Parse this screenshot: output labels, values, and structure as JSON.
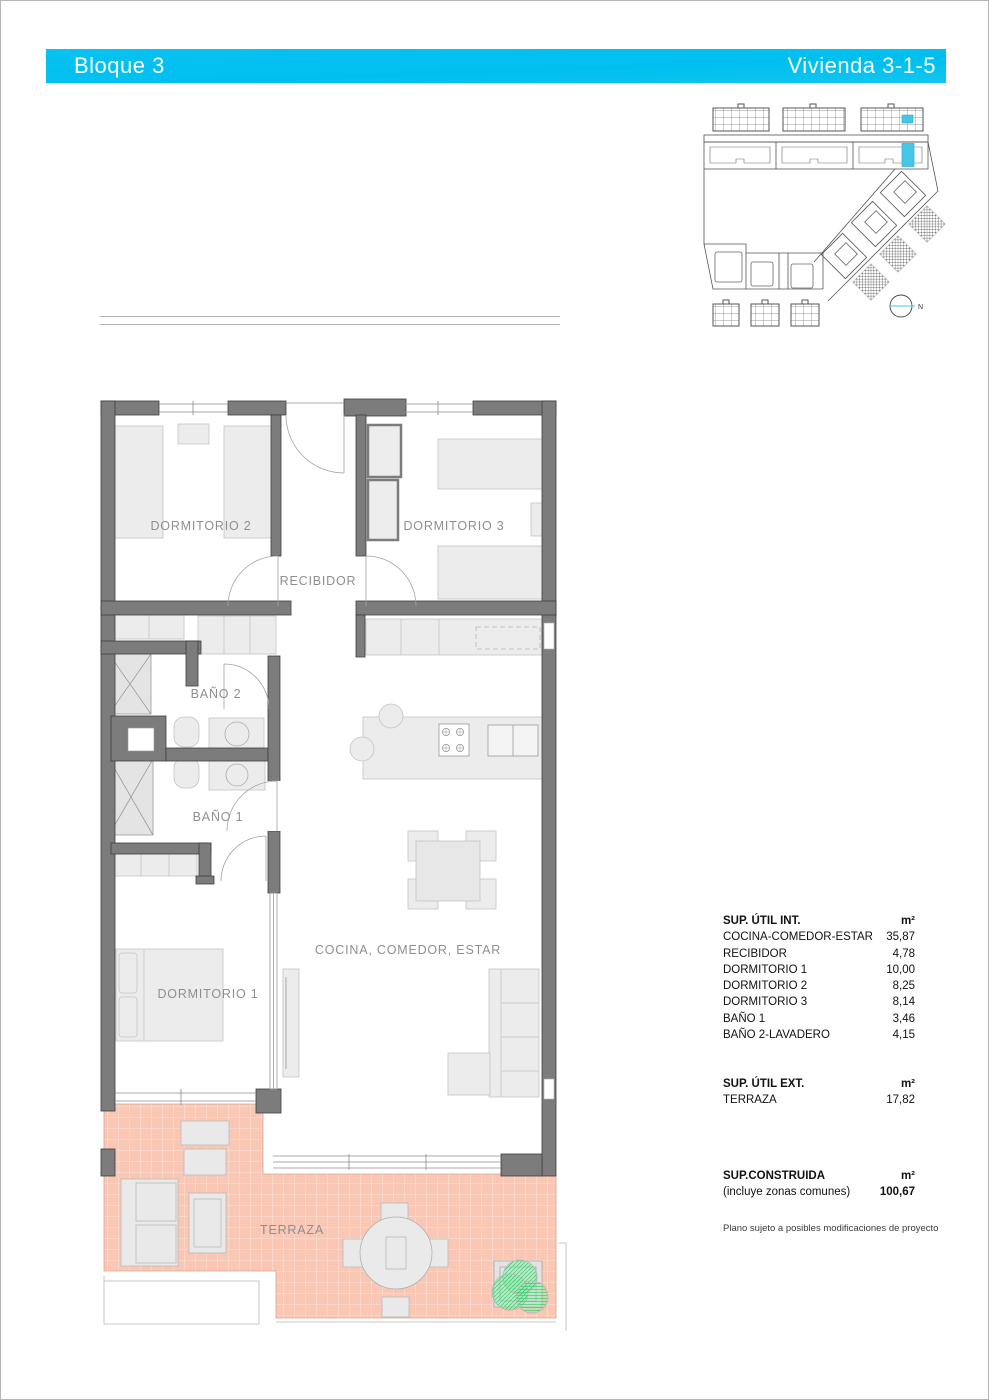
{
  "header": {
    "left": "Bloque 3",
    "right": "Vivienda 3-1-5"
  },
  "site_plan": {
    "north_label": "N"
  },
  "floor_plan": {
    "rooms": {
      "dormitorio2": "DORMITORIO 2",
      "dormitorio3": "DORMITORIO 3",
      "recibidor": "RECIBIDOR",
      "bano2": "BAÑO 2",
      "bano1": "BAÑO 1",
      "dormitorio1": "DORMITORIO 1",
      "cocina": "COCINA, COMEDOR, ESTAR",
      "terraza": "TERRAZA"
    }
  },
  "area_table": {
    "interior": {
      "title": "SUP. ÚTIL INT.",
      "unit": "m²",
      "rows": [
        {
          "label": "COCINA-COMEDOR-ESTAR",
          "value": "35,87"
        },
        {
          "label": "RECIBIDOR",
          "value": "4,78"
        },
        {
          "label": "DORMITORIO 1",
          "value": "10,00"
        },
        {
          "label": "DORMITORIO 2",
          "value": "8,25"
        },
        {
          "label": "DORMITORIO 3",
          "value": "8,14"
        },
        {
          "label": "BAÑO 1",
          "value": "3,46"
        },
        {
          "label": "BAÑO 2-LAVADERO",
          "value": "4,15"
        }
      ]
    },
    "exterior": {
      "title": "SUP. ÚTIL EXT.",
      "unit": "m²",
      "rows": [
        {
          "label": "TERRAZA",
          "value": "17,82"
        }
      ]
    },
    "built": {
      "title": "SUP.CONSTRUIDA",
      "subtitle": "(incluye zonas comunes)",
      "unit": "m²",
      "value": "100,67"
    },
    "note": "Plano sujeto a posibles modificaciones de proyecto"
  },
  "colors": {
    "accent_cyan": "#00bfef",
    "unit_highlight": "#45c8e8",
    "terrace_tile": "#f9c7b3",
    "wall_gray": "#7c7c7c",
    "plant_green": "#3ecb6c",
    "label_gray": "#8f8f8f"
  }
}
